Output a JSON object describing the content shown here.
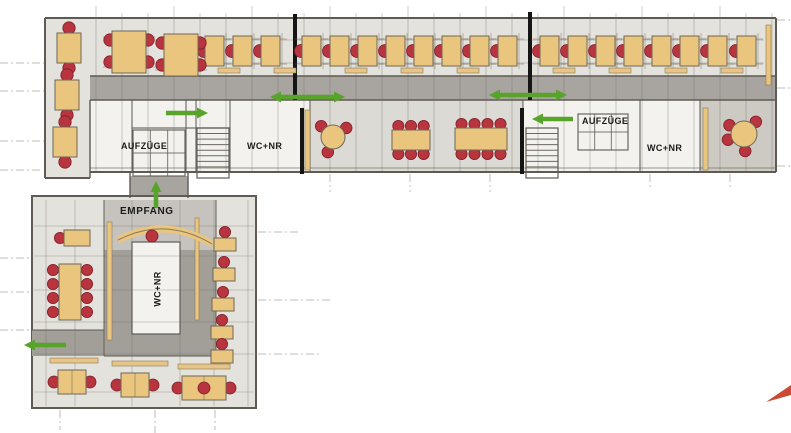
{
  "labels": {
    "elevators_west": "AUFZÜGE",
    "wc_northwest": "WC+NR",
    "elevators_east": "AUFZÜGE",
    "wc_northeast": "WC+NR",
    "reception": "EMPFANG",
    "wc_south": "WC+NR"
  },
  "icons": {
    "flow_arrow": "green-direction-arrow",
    "stairs": "stair-treads-icon",
    "elevator_shaft": "elevator-grid-icon",
    "desk": "desk-with-chair-icon",
    "meeting_table": "meeting-table-icon",
    "reception_desk": "curved-reception-desk-icon"
  },
  "colors": {
    "accent_green": "#58a32a",
    "chair_red": "#b8343e",
    "desk_tan": "#eac57d",
    "corridor_gray": "#a8a5a0",
    "floor_gray": "#e4e2dc",
    "white_room": "#f3f2ef",
    "wall_dark": "#5f5a53",
    "fire_wall_black": "#151515"
  }
}
